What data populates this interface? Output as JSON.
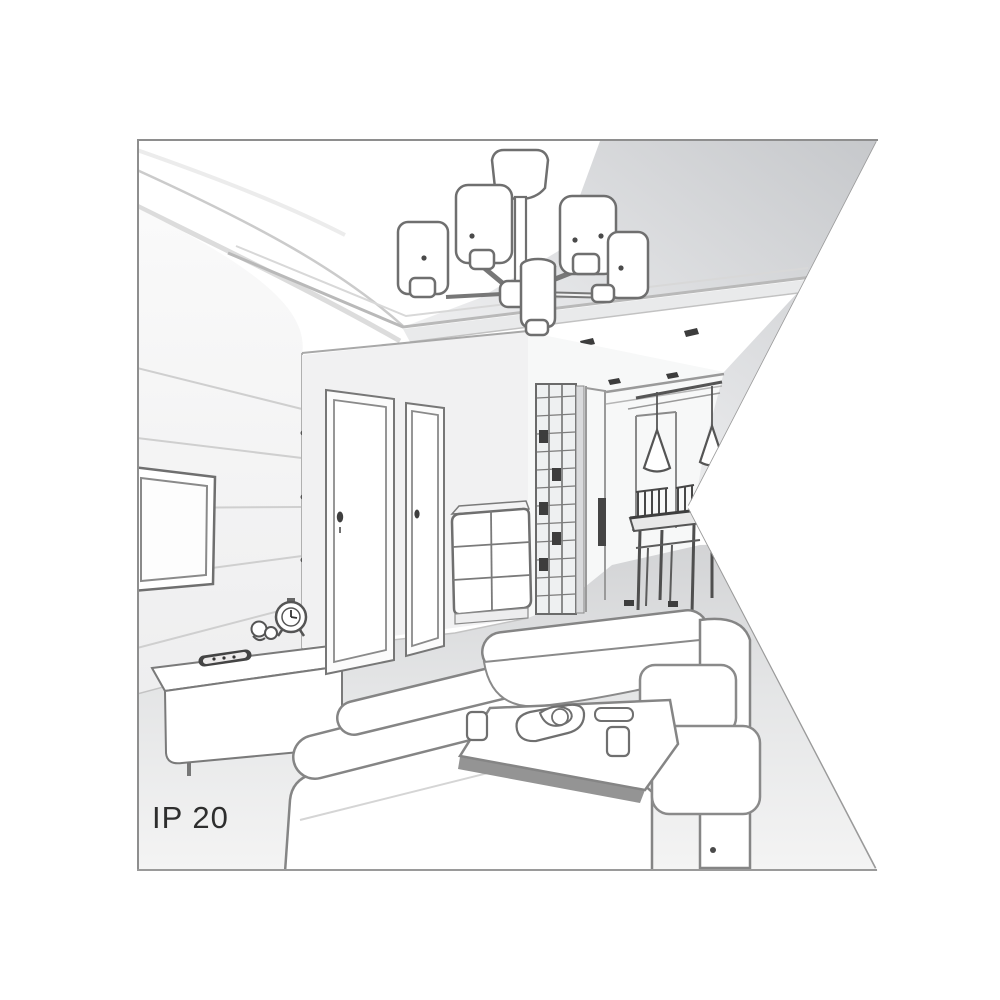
{
  "figure": {
    "label": "IP 20",
    "kind": "interior line illustration",
    "scene": "living room with six-arm cylinder-shade chandelier, dropped ceiling with spotlights, wall TV, low sideboard with alarm clock and remote, two interior doors, drawer chest, slatted wardrobe, hallway dining nook with cone pendant lamps, table and chairs, white sofas and coffee table with tray",
    "colors": {
      "background": "#ffffff",
      "outline": "#7d8184",
      "outline_dark": "#3e3e3e",
      "ceiling_shade": "#c6c8cb",
      "floor_shade": "#d2d3d5",
      "label_text": "#2e2e2e"
    }
  }
}
